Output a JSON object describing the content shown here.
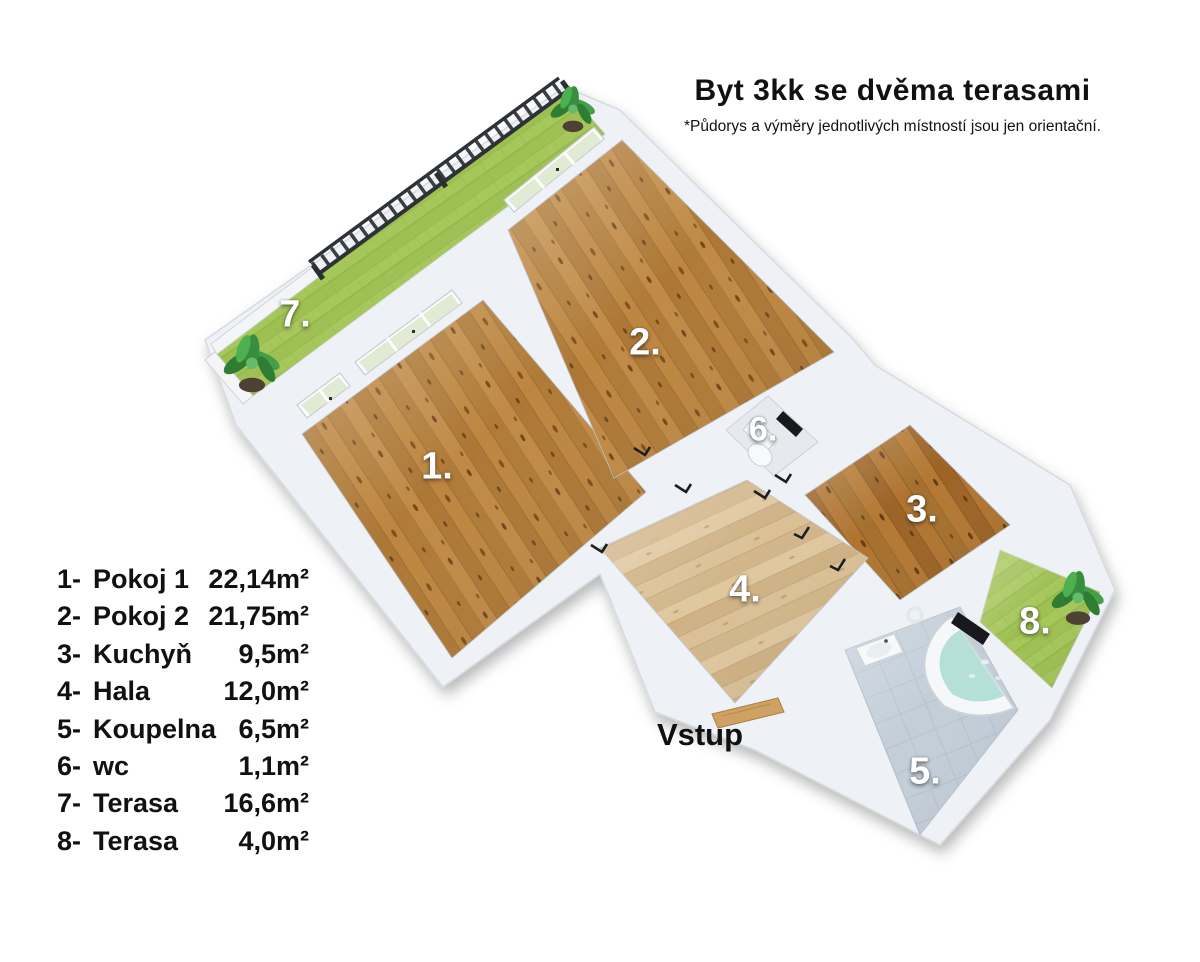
{
  "header": {
    "title": "Byt 3kk se dvěma terasami",
    "subtitle": "*Půdorys a výměry jednotlivých místností jsou jen orientační."
  },
  "plan": {
    "entrance_label": "Vstup"
  },
  "rooms": [
    {
      "plan_label": "1.",
      "legend_num": "1-",
      "name": "Pokoj 1",
      "area": "22,14m²"
    },
    {
      "plan_label": "2.",
      "legend_num": "2-",
      "name": "Pokoj 2",
      "area": "21,75m²"
    },
    {
      "plan_label": "3.",
      "legend_num": "3-",
      "name": "Kuchyň",
      "area": "9,5m²"
    },
    {
      "plan_label": "4.",
      "legend_num": "4-",
      "name": "Hala",
      "area": "12,0m²"
    },
    {
      "plan_label": "5.",
      "legend_num": "5-",
      "name": "Koupelna",
      "area": "6,5m²"
    },
    {
      "plan_label": "6.",
      "legend_num": "6-",
      "name": "wc",
      "area": "1,1m²"
    },
    {
      "plan_label": "7.",
      "legend_num": "7-",
      "name": "Terasa",
      "area": "16,6m²"
    },
    {
      "plan_label": "8.",
      "legend_num": "8-",
      "name": "Terasa",
      "area": "4,0m²"
    }
  ],
  "colors": {
    "wall": "#eef1f5",
    "wall_edge": "#d5dbe0",
    "wood_room": "#b6813f",
    "wood_kitchen": "#a96e2b",
    "wood_hall": "#d7bd92",
    "terrace_green": "#a5c75a",
    "bath_tile": "#c3ced9",
    "tub_water": "#b5e0d8",
    "railing_dark": "#33383d",
    "door_wood": "#cfa264",
    "label_white": "#ffffff",
    "text_black": "#111111"
  }
}
